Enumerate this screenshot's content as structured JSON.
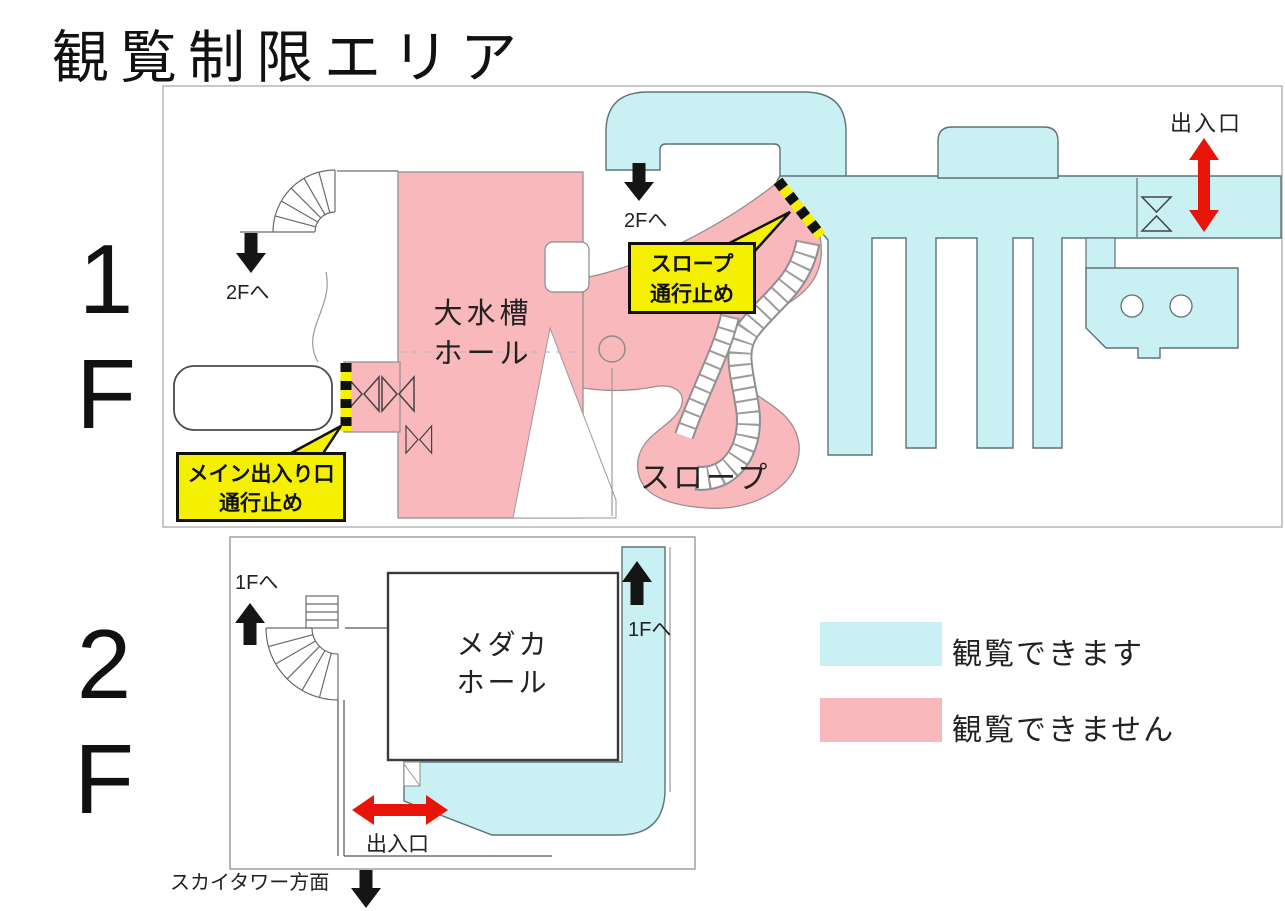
{
  "title": "観覧制限エリア",
  "floor1": {
    "number": "1",
    "letter": "F",
    "hall_line1": "大水槽",
    "hall_line2": "ホール",
    "slope_label": "スロープ",
    "to_2f_stairs": "2Fへ",
    "to_2f_ramp": "2Fへ",
    "exit_label": "出入口",
    "warning_slope_line1": "スロープ",
    "warning_slope_line2": "通行止め",
    "warning_main_line1": "メイン出入り口",
    "warning_main_line2": "通行止め"
  },
  "floor2": {
    "number": "2",
    "letter": "F",
    "hall_line1": "メダカ",
    "hall_line2": "ホール",
    "to_1f_stairs": "1Fへ",
    "to_1f_corridor": "1Fへ",
    "exit_label": "出入口",
    "skytower_label": "スカイタワー方面"
  },
  "legend": {
    "viewable_label": "観覧できます",
    "restricted_label": "観覧できません",
    "viewable_color": "#c9f0f2",
    "restricted_color": "#f9b8bc"
  },
  "colors": {
    "open_area": "#c9f0f2",
    "closed_area": "#f9b8bc",
    "warning_bg": "#f4f000",
    "arrow_red": "#e81309",
    "arrow_black": "#151515"
  }
}
